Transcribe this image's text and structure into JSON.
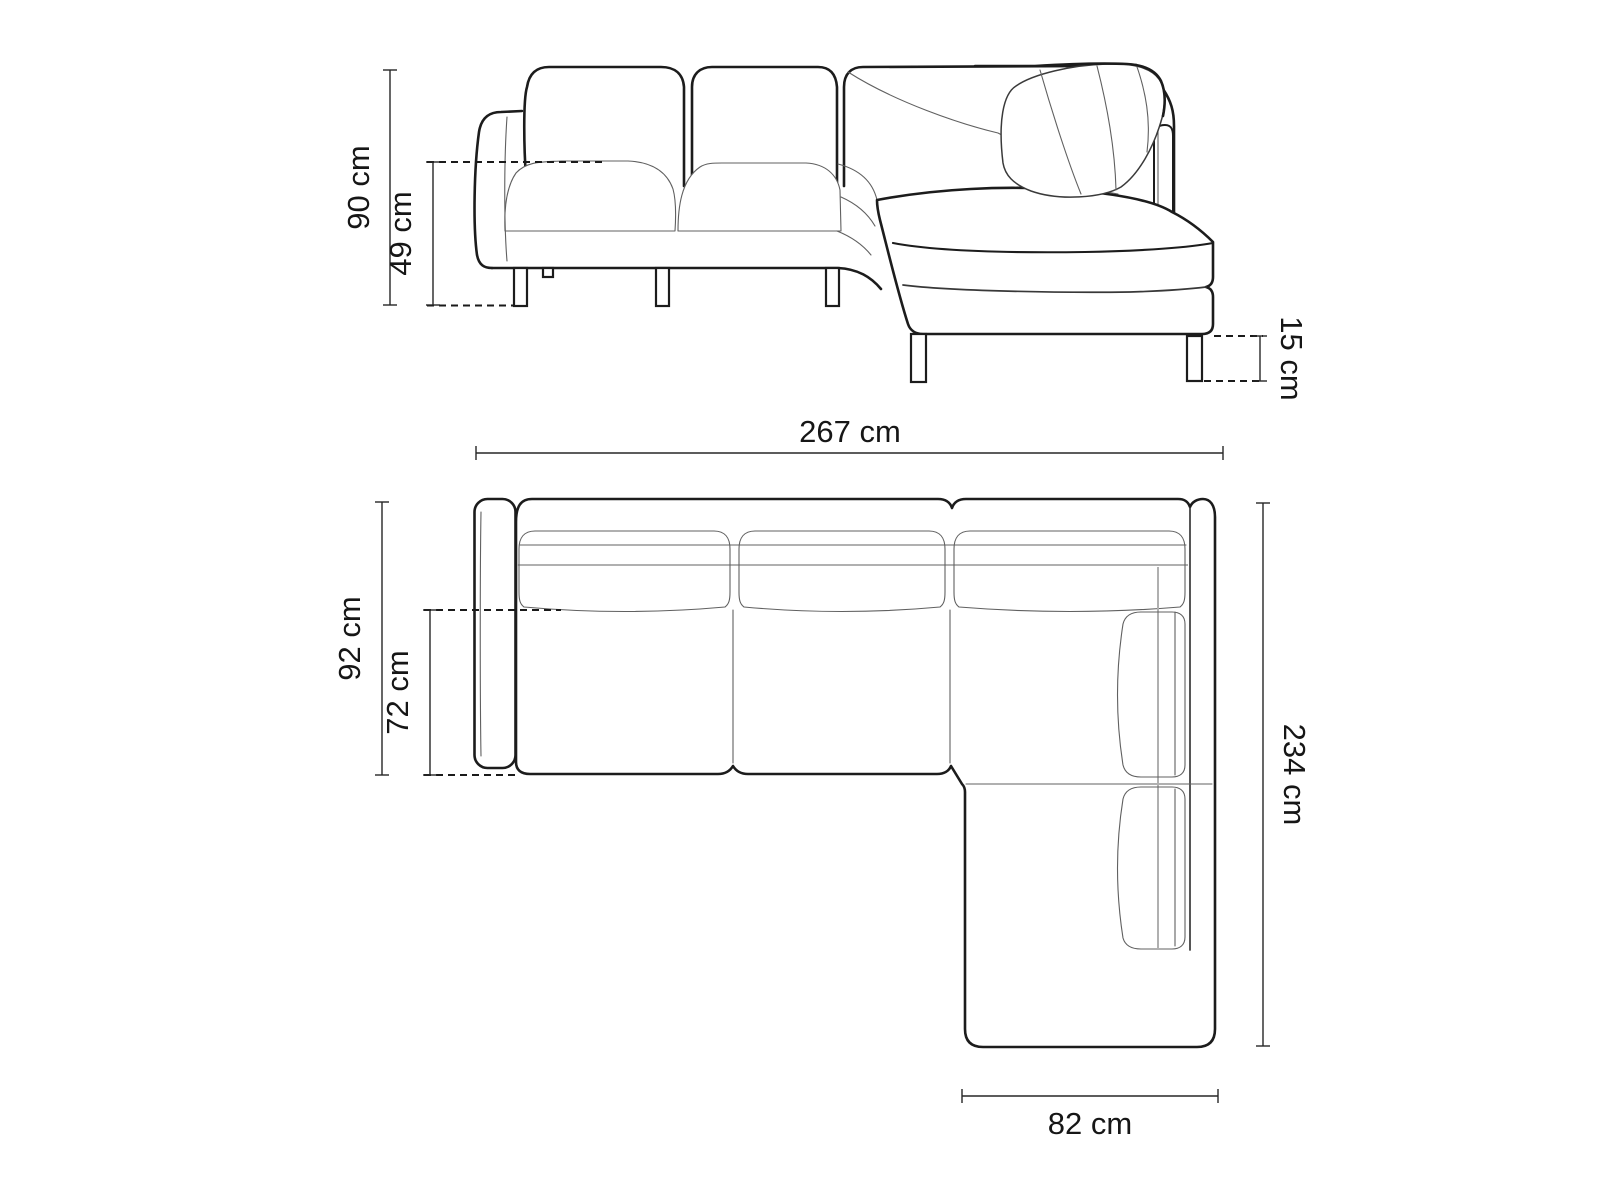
{
  "diagram": {
    "kind": "furniture-dimension-diagram",
    "subject": "corner-sofa",
    "side_view": {
      "height_total_label": "90 cm",
      "seat_height_label": "49 cm",
      "leg_height_label": "15 cm"
    },
    "top_view": {
      "width_total_label": "267 cm",
      "depth_total_label": "92 cm",
      "seat_depth_label": "72 cm",
      "side_length_label": "234 cm",
      "chaise_width_label": "82 cm"
    },
    "values_cm": {
      "total_height": 90,
      "seat_height": 49,
      "leg_height": 15,
      "total_width": 267,
      "total_depth": 92,
      "seat_depth": 72,
      "side_length": 234,
      "chaise_width": 82
    },
    "colors": {
      "background": "#ffffff",
      "outline": "#1c1c1c",
      "seam": "#606060",
      "soft_seam": "#b0b0b0",
      "dimension_line": "#262626",
      "label_text": "#161616"
    }
  }
}
